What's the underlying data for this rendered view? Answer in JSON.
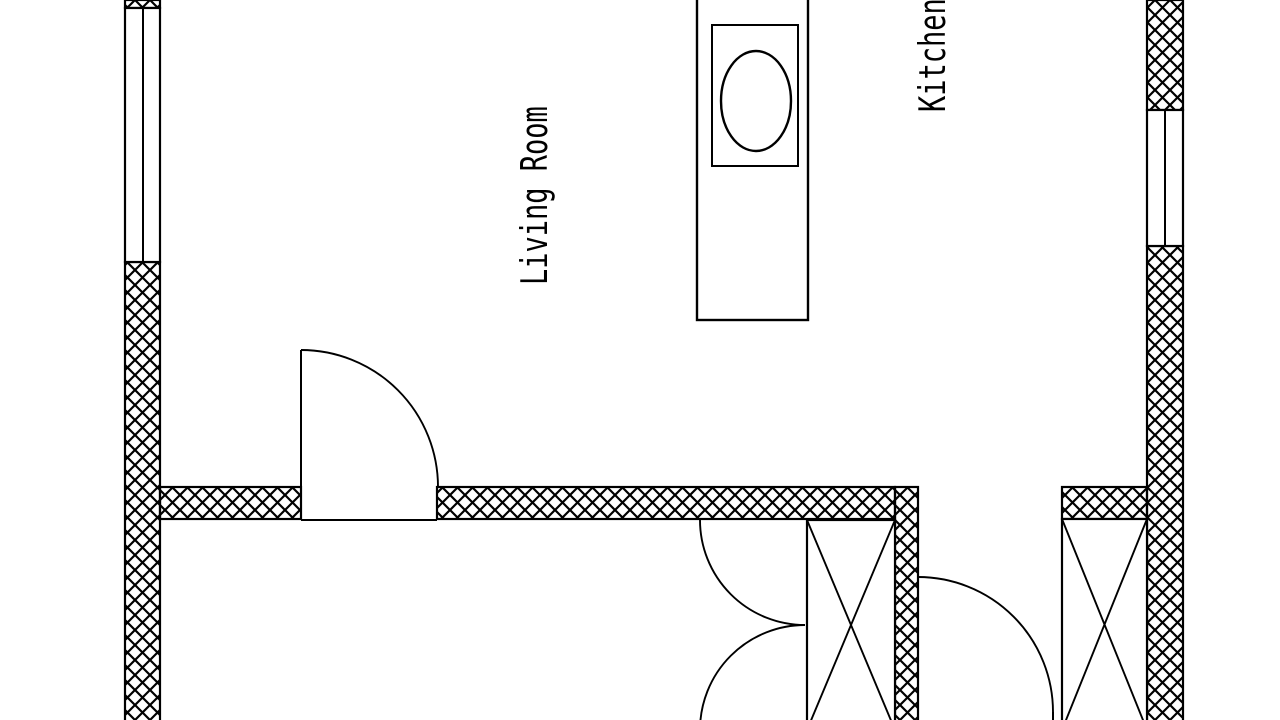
{
  "floor_plan": {
    "colors": {
      "background": "#ffffff",
      "lines": "#000000"
    },
    "room_labels": [
      {
        "id": "living-room",
        "text": "Living Room"
      },
      {
        "id": "kitchen",
        "text": "Kitchen"
      }
    ]
  }
}
